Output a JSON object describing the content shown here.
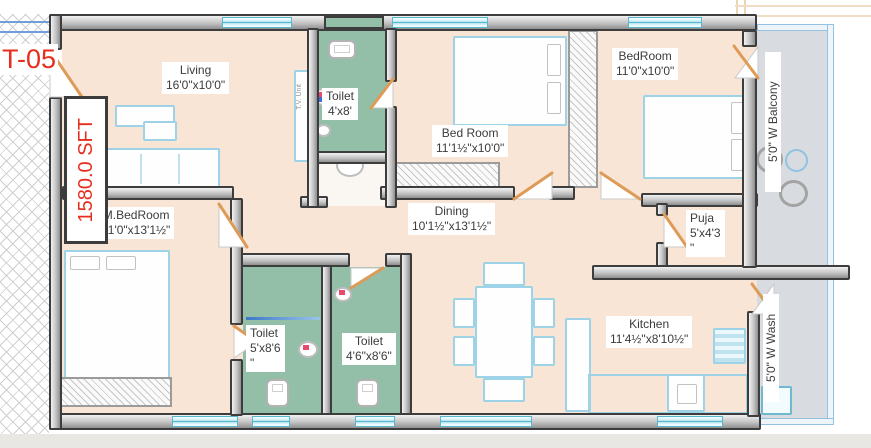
{
  "plan": {
    "unit_label": "T-05",
    "area_label": "1580.0 SFT",
    "rooms": [
      {
        "name": "Living",
        "dims": "16'0\"x10'0\""
      },
      {
        "name": "Toilet",
        "dims": "4'x8'"
      },
      {
        "name": "Bed Room",
        "dims": "11'1½\"x10'0\""
      },
      {
        "name": "BedRoom",
        "dims": "11'0\"x10'0\""
      },
      {
        "name": "M.BedRoom",
        "dims": "11'0\"x13'1½\""
      },
      {
        "name": "Dining",
        "dims": "10'1½\"x13'1½\""
      },
      {
        "name": "Puja",
        "dims": "5'x4'3",
        "dims_overflow": "\""
      },
      {
        "name": "Toilet",
        "dims": "5'x8'6",
        "dims_overflow": "\""
      },
      {
        "name": "Toilet",
        "dims": "4'6\"x8'6\""
      },
      {
        "name": "Kitchen",
        "dims": "11'4½\"x8'10½\""
      }
    ],
    "annotations": {
      "balcony": "5'0\" W Balcony",
      "wash": "5'0\" W Wash",
      "tv_unit": "T.V. Unit"
    },
    "colors": {
      "floor": "#f8e5d5",
      "toilet_floor": "#93bfa9",
      "balcony_floor": "#d8dbdf",
      "wall": "#3d3d3d",
      "door": "#dd9b57",
      "window": "#58b7cc",
      "furniture_outline": "#9ed2e6",
      "highlight_red": "#e62e1f"
    }
  }
}
